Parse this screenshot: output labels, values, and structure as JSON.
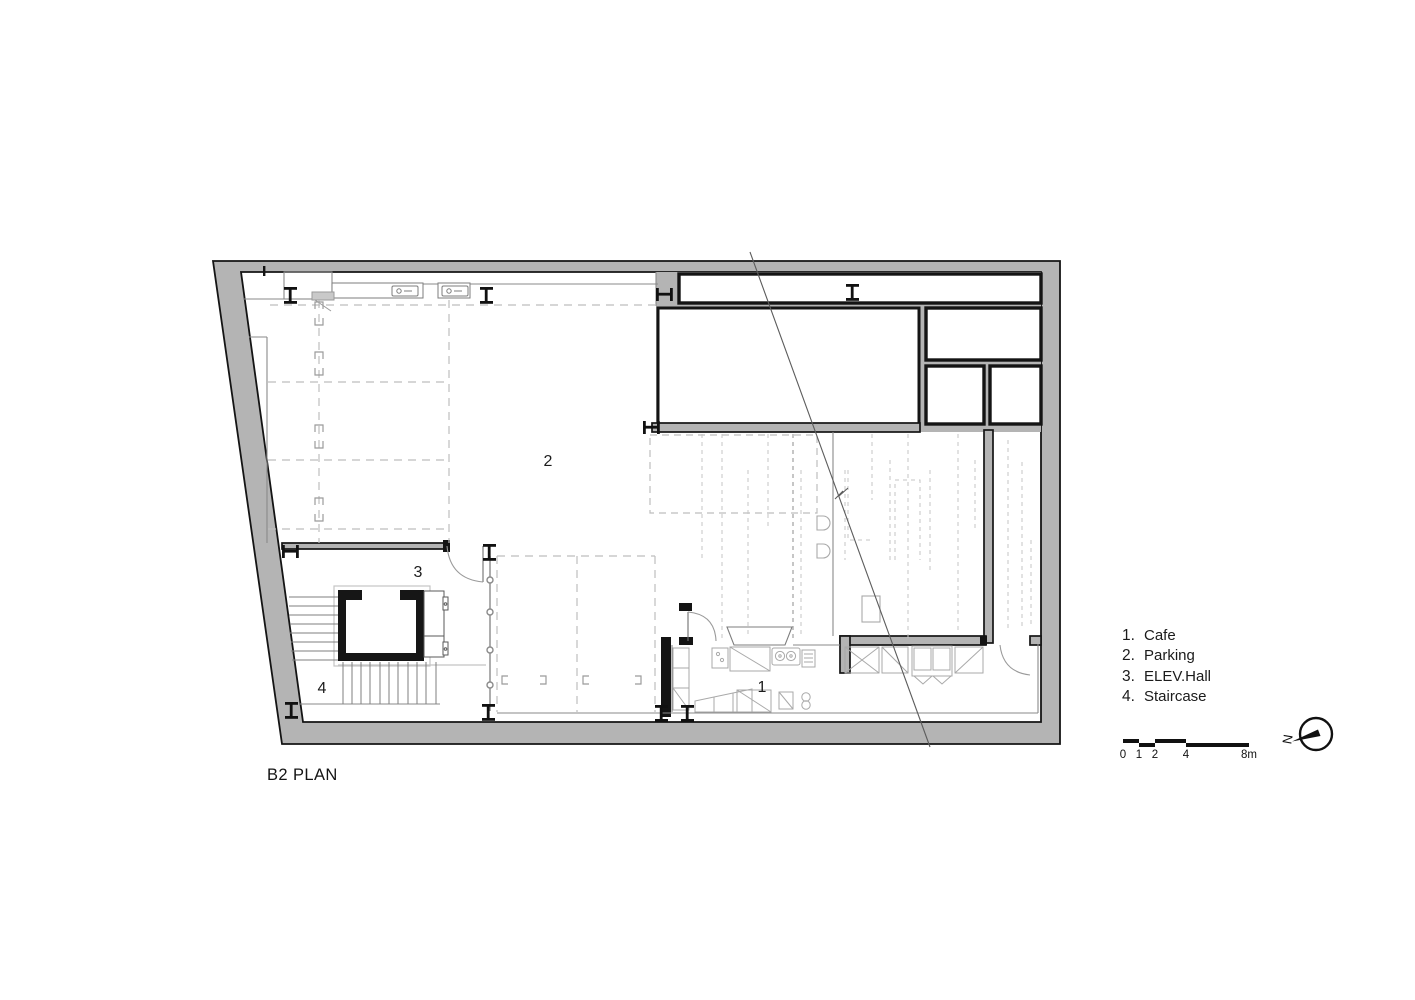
{
  "title": "B2 PLAN",
  "plan": {
    "room_numbers": {
      "cafe": "1",
      "parking": "2",
      "elev_hall": "3",
      "staircase": "4"
    }
  },
  "legend": {
    "items": [
      {
        "number": "1.",
        "label": "Cafe"
      },
      {
        "number": "2.",
        "label": "Parking"
      },
      {
        "number": "3.",
        "label": "ELEV.Hall"
      },
      {
        "number": "4.",
        "label": "Staircase"
      }
    ]
  },
  "scale_bar": {
    "ticks": [
      "0",
      "1",
      "2",
      "4",
      "8m"
    ],
    "unit": "m"
  },
  "north": {
    "label": "N"
  },
  "colors": {
    "wall_poche": "#b4b4b4",
    "wall_line": "#141414",
    "thin_line": "#8a8a8a",
    "light_fixture": "#a9a9a9",
    "dashed_marking": "#bdbdbd",
    "background": "#ffffff"
  }
}
